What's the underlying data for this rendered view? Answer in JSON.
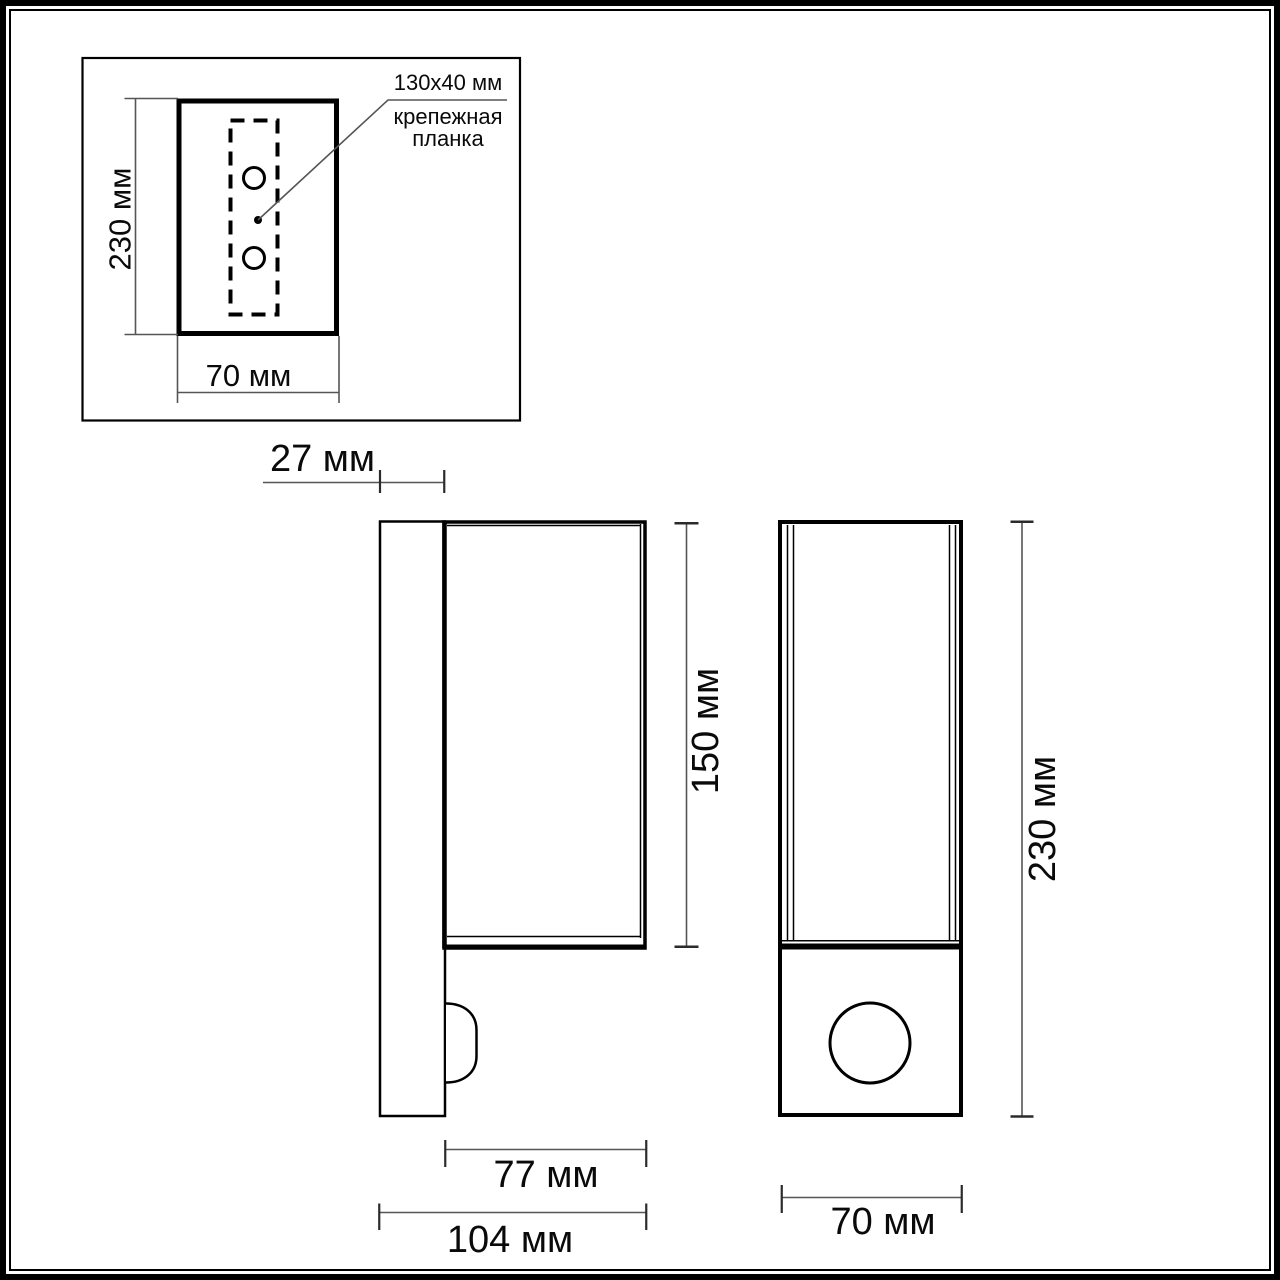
{
  "drawing": {
    "rear_inset": {
      "height_dim": "230 мм",
      "width_dim": "70 мм",
      "plate_size": "130x40 мм",
      "plate_label_line1": "крепежная",
      "plate_label_line2": "планка"
    },
    "side_view": {
      "plate_depth_dim": "27 мм",
      "body_height_dim": "150 мм",
      "body_depth_dim": "77 мм",
      "total_depth_dim": "104 мм"
    },
    "front_view": {
      "height_dim": "230 мм",
      "width_dim": "70 мм"
    },
    "colors": {
      "line": "#000000",
      "thin_line": "#555555",
      "background": "#ffffff"
    }
  }
}
